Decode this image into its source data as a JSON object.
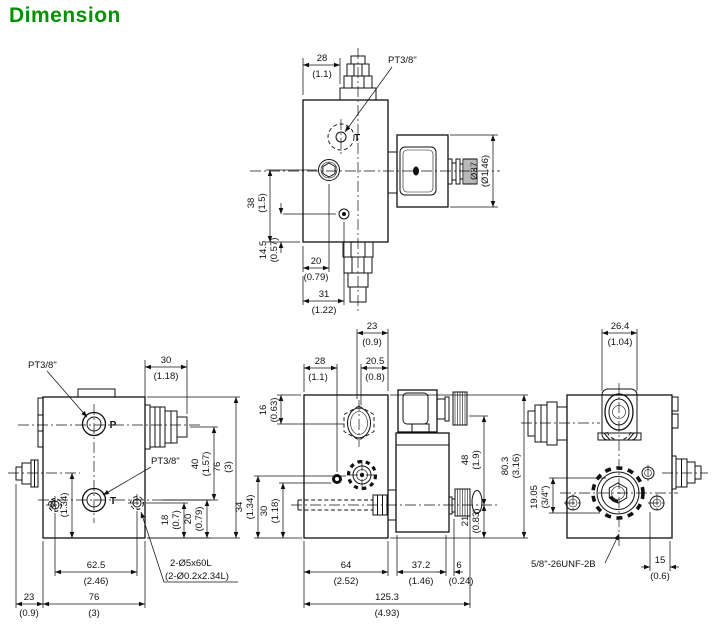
{
  "title": "Dimension",
  "colors": {
    "line": "#111111",
    "title": "#019101",
    "background": "#ffffff"
  },
  "views": {
    "top": {
      "port_t": "T",
      "thread_label": "PT3/8\"",
      "dims": {
        "w28": {
          "mm": "28",
          "inch": "(1.1)"
        },
        "d37": {
          "mm": "Ø37",
          "inch": "(Ø1.46)"
        },
        "h38": {
          "mm": "38",
          "inch": "(1.5)"
        },
        "h145": {
          "mm": "14.5",
          "inch": "(0.57)"
        },
        "w20": {
          "mm": "20",
          "inch": "(0.79)"
        },
        "w31": {
          "mm": "31",
          "inch": "(1.22)"
        }
      }
    },
    "front": {
      "port_p": "P",
      "port_t": "T",
      "thread_label_p": "PT3/8\"",
      "thread_label_t": "PT3/8\"",
      "hole_note_line1": "2-Ø5x60L",
      "hole_note_line2": "(2-Ø0.2x2.34L)",
      "dims": {
        "w30": {
          "mm": "30",
          "inch": "(1.18)"
        },
        "h40": {
          "mm": "40",
          "inch": "(1.57)"
        },
        "h76": {
          "mm": "76",
          "inch": "(3)"
        },
        "h34": {
          "mm": "34",
          "inch": "(1.34)"
        },
        "h18": {
          "mm": "18",
          "inch": "(0.7)"
        },
        "h20": {
          "mm": "20",
          "inch": "(0.79)"
        },
        "w625": {
          "mm": "62.5",
          "inch": "(2.46)"
        },
        "w76": {
          "mm": "76",
          "inch": "(3)"
        },
        "w23": {
          "mm": "23",
          "inch": "(0.9)"
        }
      }
    },
    "side": {
      "dims": {
        "w23": {
          "mm": "23",
          "inch": "(0.9)"
        },
        "w28": {
          "mm": "28",
          "inch": "(1.1)"
        },
        "w205": {
          "mm": "20.5",
          "inch": "(0.8)"
        },
        "h16": {
          "mm": "16",
          "inch": "(0.63)"
        },
        "h34": {
          "mm": "34",
          "inch": "(1.34)"
        },
        "h30": {
          "mm": "30",
          "inch": "(1.18)"
        },
        "h48": {
          "mm": "48",
          "inch": "(1.9)"
        },
        "h803": {
          "mm": "80.3",
          "inch": "(3.16)"
        },
        "h21": {
          "mm": "21",
          "inch": "(0.83)"
        },
        "w64": {
          "mm": "64",
          "inch": "(2.52)"
        },
        "w372": {
          "mm": "37.2",
          "inch": "(1.46)"
        },
        "w6": {
          "mm": "6",
          "inch": "(0.24)"
        },
        "w1253": {
          "mm": "125.3",
          "inch": "(4.93)"
        }
      }
    },
    "back": {
      "thread_note": "5/8\"-26UNF-2B",
      "dims": {
        "w264": {
          "mm": "26.4",
          "inch": "(1.04)"
        },
        "h1905": {
          "mm": "19.05",
          "inch": "(3/4\")"
        },
        "w15": {
          "mm": "15",
          "inch": "(0.6)"
        }
      }
    }
  }
}
